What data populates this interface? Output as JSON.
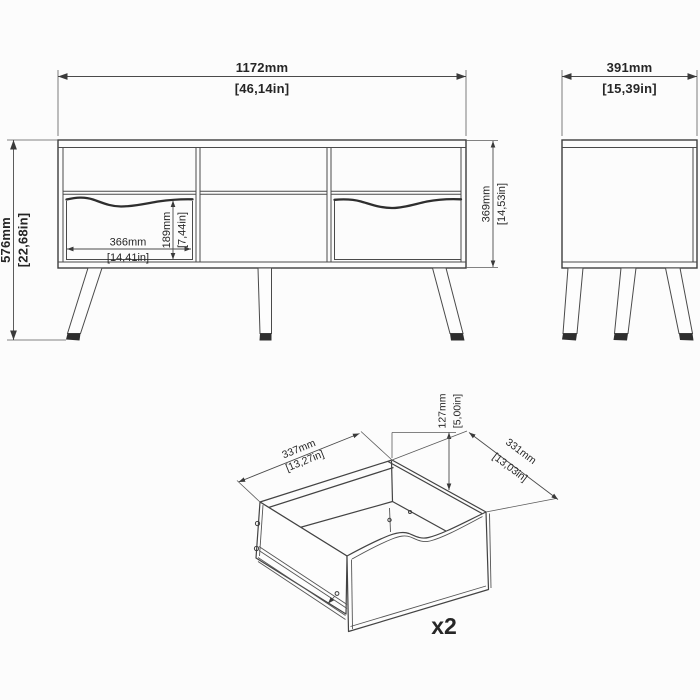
{
  "drawing": {
    "type": "furniture-dimension-diagram",
    "units": [
      "mm",
      "in"
    ]
  },
  "front_view": {
    "width": {
      "mm": "1172mm",
      "inch": "[46,14in]"
    },
    "height": {
      "mm": "576mm",
      "inch": "[22,68in]"
    },
    "drawer_width": {
      "mm": "366mm",
      "inch": "[14,41in]"
    },
    "drawer_height": {
      "mm": "189mm",
      "inch": "[7,44in]"
    },
    "interior_height": {
      "mm": "369mm",
      "inch": "[14,53in]"
    }
  },
  "side_view": {
    "depth": {
      "mm": "391mm",
      "inch": "[15,39in]"
    }
  },
  "drawer_detail": {
    "width": {
      "mm": "337mm",
      "inch": "[13,27in]"
    },
    "height": {
      "mm": "127mm",
      "inch": "[5,00in]"
    },
    "depth": {
      "mm": "331mm",
      "inch": "[13,03in]"
    },
    "quantity_label": "x2"
  },
  "colors": {
    "background": "#fcfcfc",
    "line": "#3d3d3d",
    "dimension_line": "#4a4a4a",
    "text": "#262626",
    "foot_pad": "#2e2e2e"
  }
}
